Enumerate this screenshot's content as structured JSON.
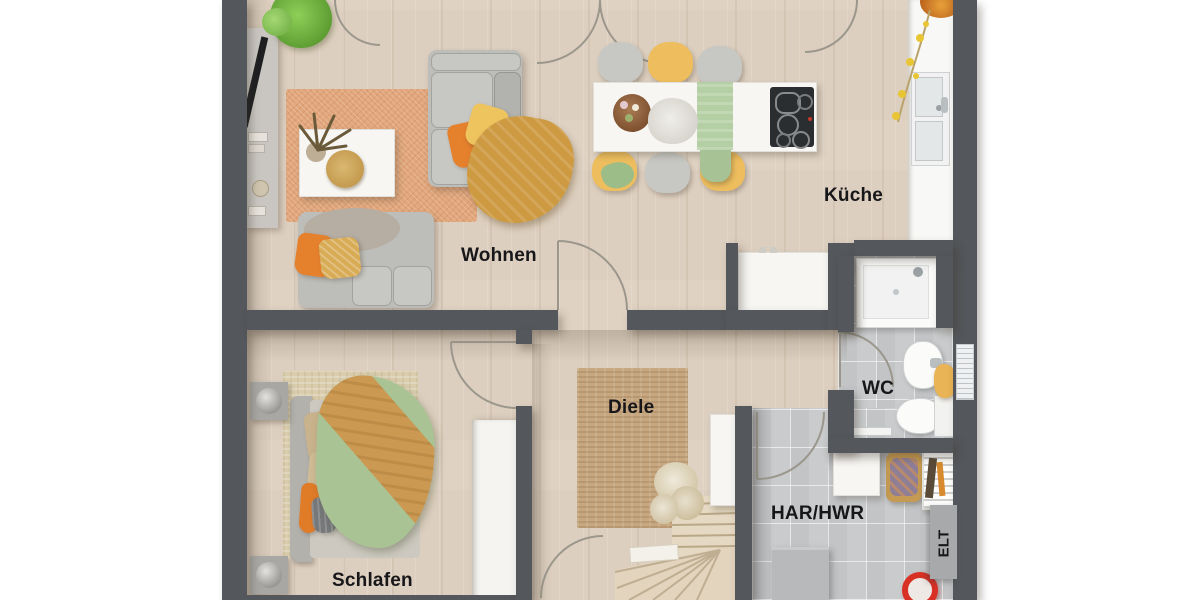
{
  "floorplan": {
    "rooms": [
      {
        "id": "wohnen",
        "label": "Wohnen"
      },
      {
        "id": "kueche",
        "label": "Küche"
      },
      {
        "id": "diele",
        "label": "Diele"
      },
      {
        "id": "wc",
        "label": "WC"
      },
      {
        "id": "har-hwr",
        "label": "HAR/HWR"
      },
      {
        "id": "schlafen",
        "label": "Schlafen"
      },
      {
        "id": "elt",
        "label": "ELT"
      }
    ],
    "colors": {
      "wall": "#54575b",
      "wood_floor": "#ddcfbf",
      "tile_floor": "#c9cbcd",
      "rug_terracotta": "#e1a67b",
      "rug_jute": "#c7a77f",
      "accent_orange": "#e5812d",
      "accent_yellow": "#eebe5e",
      "accent_green": "#a9c394",
      "blanket_mustard": "#cd9a42"
    },
    "furniture": {
      "wohnen": [
        "tv-sideboard",
        "plant",
        "terracotta-rug",
        "coffee-table",
        "sofa",
        "loveseat",
        "pillows",
        "throw-blanket"
      ],
      "kueche": [
        "dining-table",
        "six-chairs",
        "centerpiece-bowl",
        "bouquet",
        "table-runner",
        "cooktop",
        "counter-with-sink",
        "fruit-bowl",
        "sideboard"
      ],
      "schlafen": [
        "double-bed",
        "duvet",
        "throw-blanket",
        "pillows",
        "rug",
        "two-nightstands",
        "lamps",
        "wardrobe"
      ],
      "diele": [
        "jute-rug",
        "winder-staircase",
        "dried-plant"
      ],
      "wc": [
        "shower",
        "washbasin",
        "toilet",
        "radiator",
        "towel",
        "towel-rail"
      ],
      "har_hwr": [
        "washing-box",
        "laundry-basket",
        "drying-rack",
        "storage-box",
        "bucket",
        "electrical-cabinet"
      ]
    }
  }
}
